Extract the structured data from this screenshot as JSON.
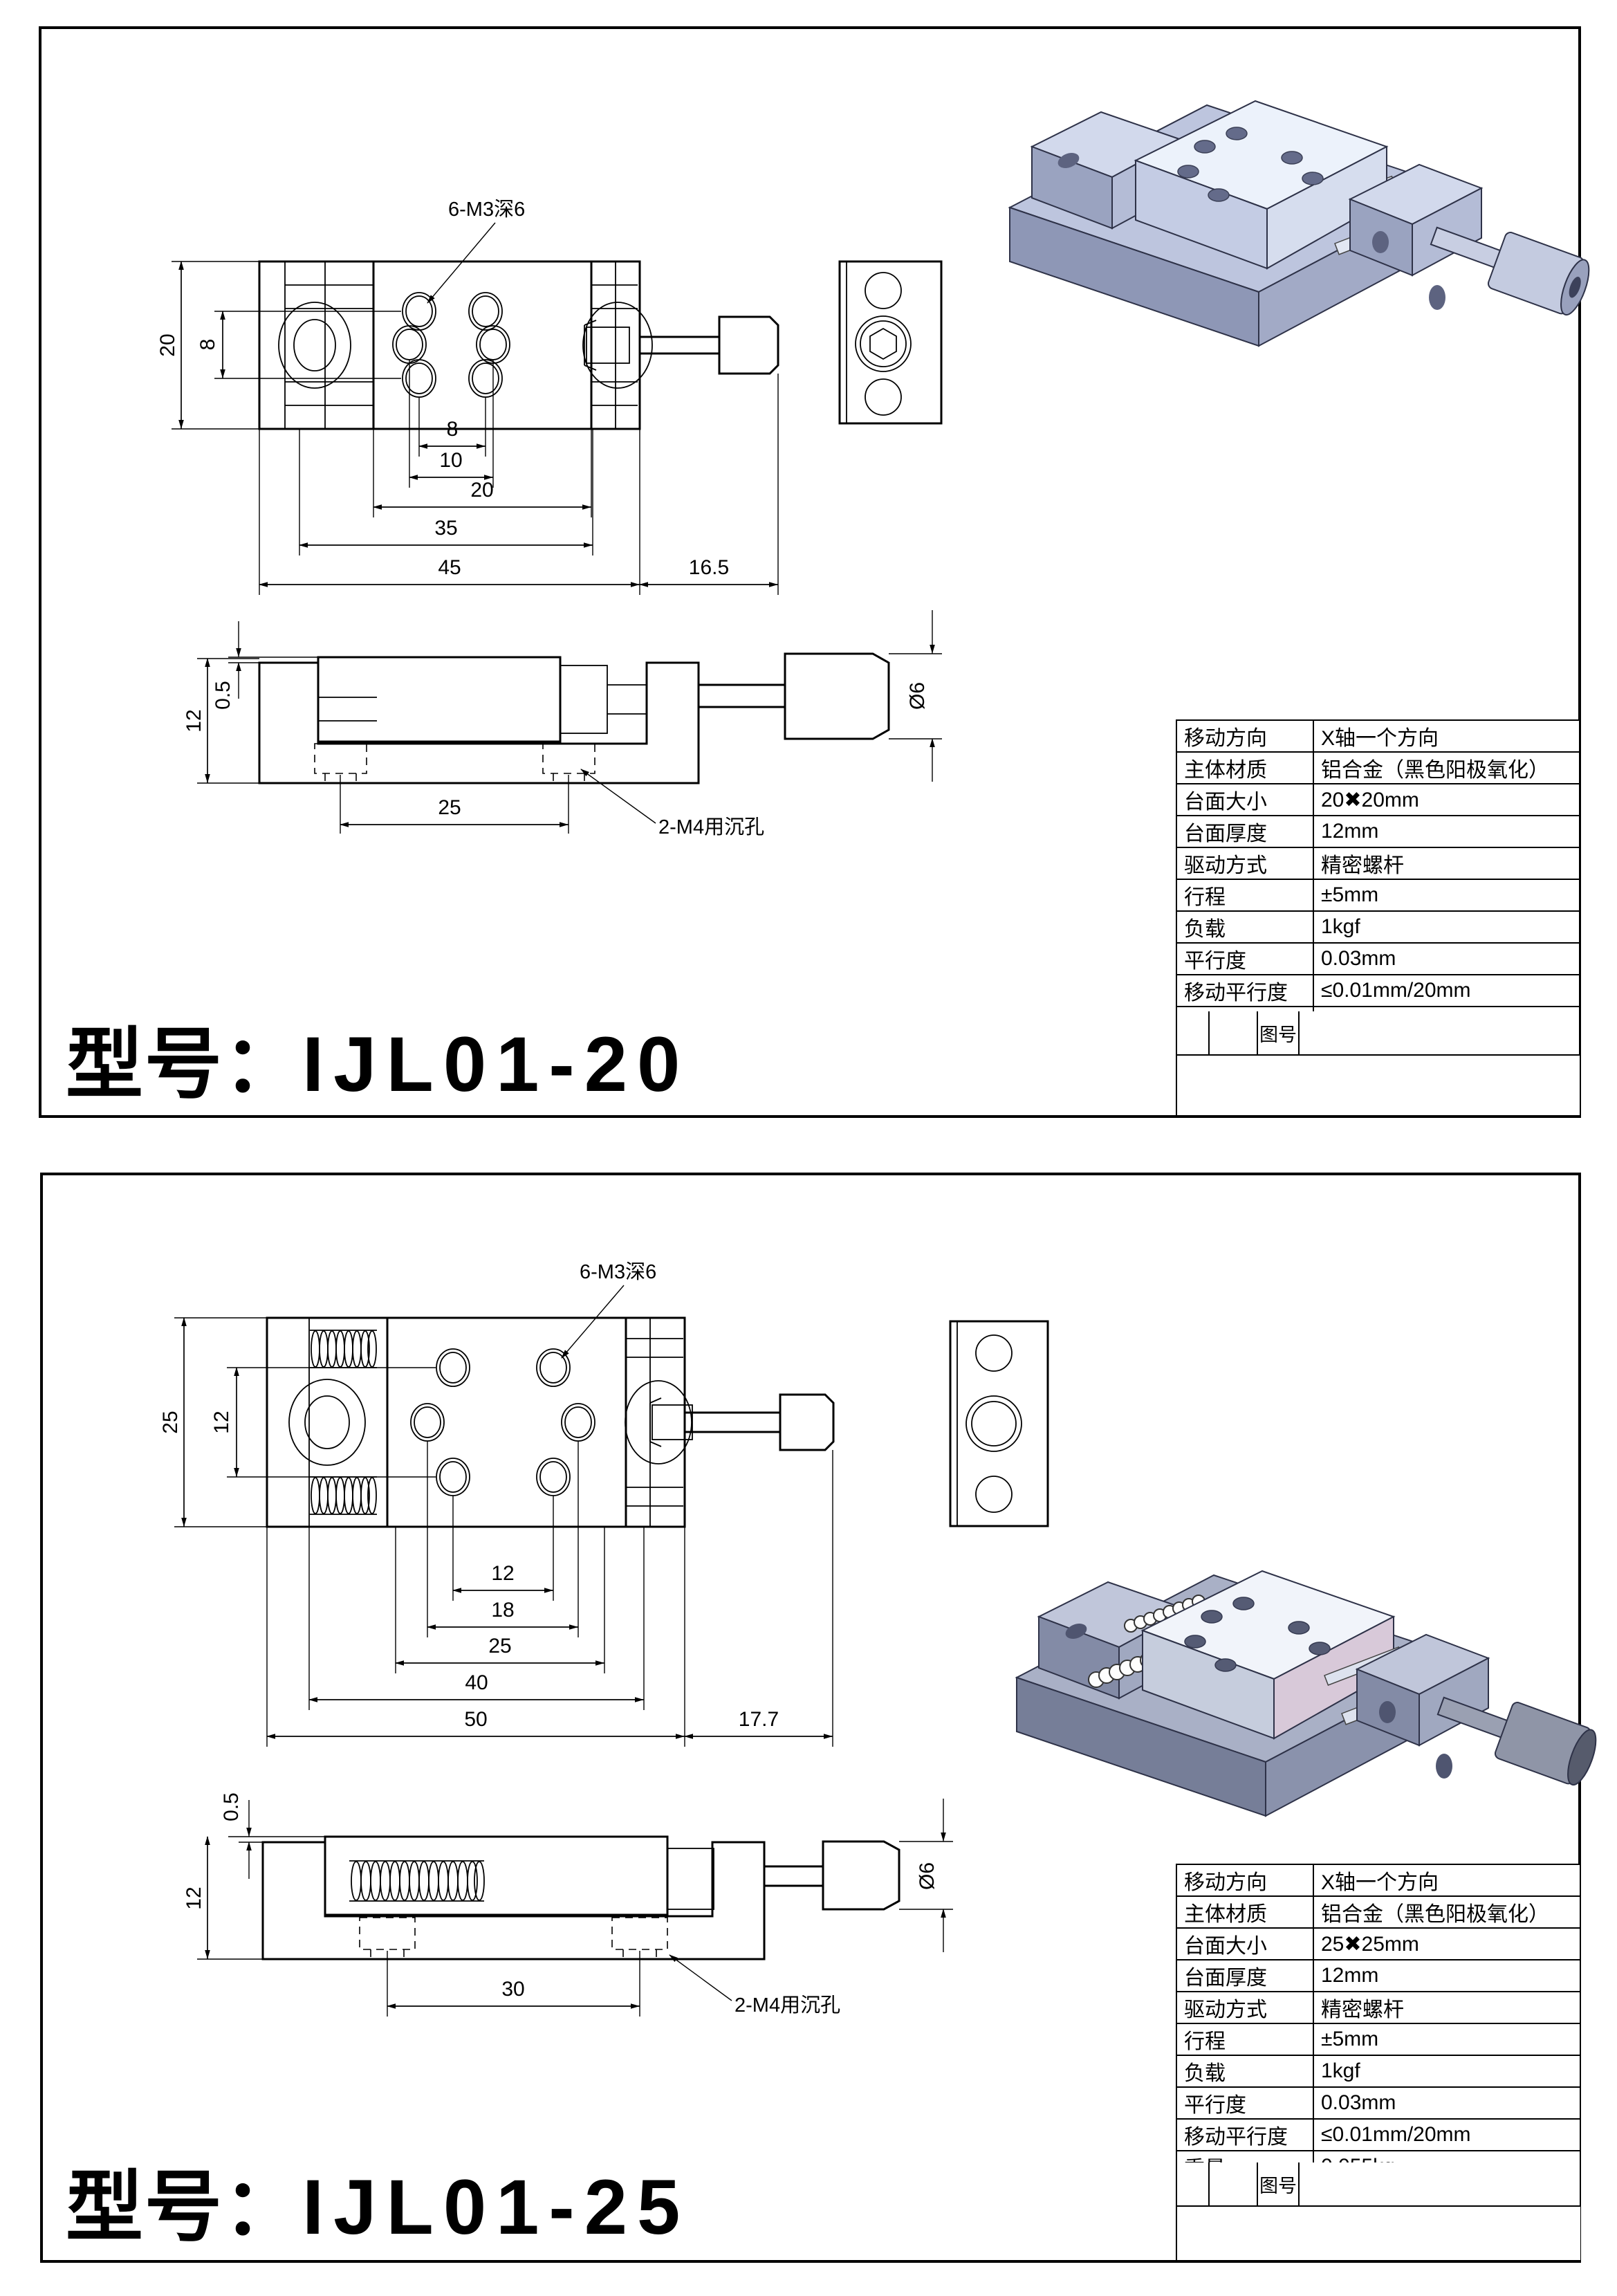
{
  "panels": [
    {
      "model_prefix": "型号：",
      "model_number": "IJL01-20",
      "notes": {
        "thread_note": "6-M3深6",
        "counterbore_note": "2-M4用沉孔",
        "shaft_dia": "Ø6"
      },
      "dims": {
        "v_height": "20",
        "v_holes": "8",
        "h_holes_near": "8",
        "h_holes_far": "10",
        "h_platform": "20",
        "h_inner": "35",
        "h_body": "45",
        "h_knob": "16.5",
        "s_thickness": "12",
        "s_step": "0.5",
        "s_span": "25"
      },
      "table": {
        "rows": [
          {
            "label": "移动方向",
            "value": "X轴一个方向"
          },
          {
            "label": "主体材质",
            "value": "铝合金（黑色阳极氧化）"
          },
          {
            "label": "台面大小",
            "value": "20✖20mm"
          },
          {
            "label": "台面厚度",
            "value": "12mm"
          },
          {
            "label": "驱动方式",
            "value": "精密螺杆"
          },
          {
            "label": "行程",
            "value": "±5mm"
          },
          {
            "label": "负载",
            "value": "1kgf"
          },
          {
            "label": "平行度",
            "value": "0.03mm"
          },
          {
            "label": "移动平行度",
            "value": "≤0.01mm/20mm"
          },
          {
            "label": "重量",
            "value": "0.038kg"
          }
        ],
        "figure_label": "图号"
      }
    },
    {
      "model_prefix": "型号：",
      "model_number": "IJL01-25",
      "notes": {
        "thread_note": "6-M3深6",
        "counterbore_note": "2-M4用沉孔",
        "shaft_dia": "Ø6"
      },
      "dims": {
        "v_height": "25",
        "v_holes": "12",
        "h_holes_near": "12",
        "h_holes_far": "18",
        "h_platform": "25",
        "h_inner": "40",
        "h_body": "50",
        "h_knob": "17.7",
        "s_thickness": "12",
        "s_step": "0.5",
        "s_span": "30"
      },
      "table": {
        "rows": [
          {
            "label": "移动方向",
            "value": "X轴一个方向"
          },
          {
            "label": "主体材质",
            "value": "铝合金（黑色阳极氧化）"
          },
          {
            "label": "台面大小",
            "value": "25✖25mm"
          },
          {
            "label": "台面厚度",
            "value": "12mm"
          },
          {
            "label": "驱动方式",
            "value": "精密螺杆"
          },
          {
            "label": "行程",
            "value": "±5mm"
          },
          {
            "label": "负载",
            "value": "1kgf"
          },
          {
            "label": "平行度",
            "value": "0.03mm"
          },
          {
            "label": "移动平行度",
            "value": "≤0.01mm/20mm"
          },
          {
            "label": "重量",
            "value": "0.055kg"
          }
        ],
        "figure_label": "图号"
      }
    }
  ]
}
